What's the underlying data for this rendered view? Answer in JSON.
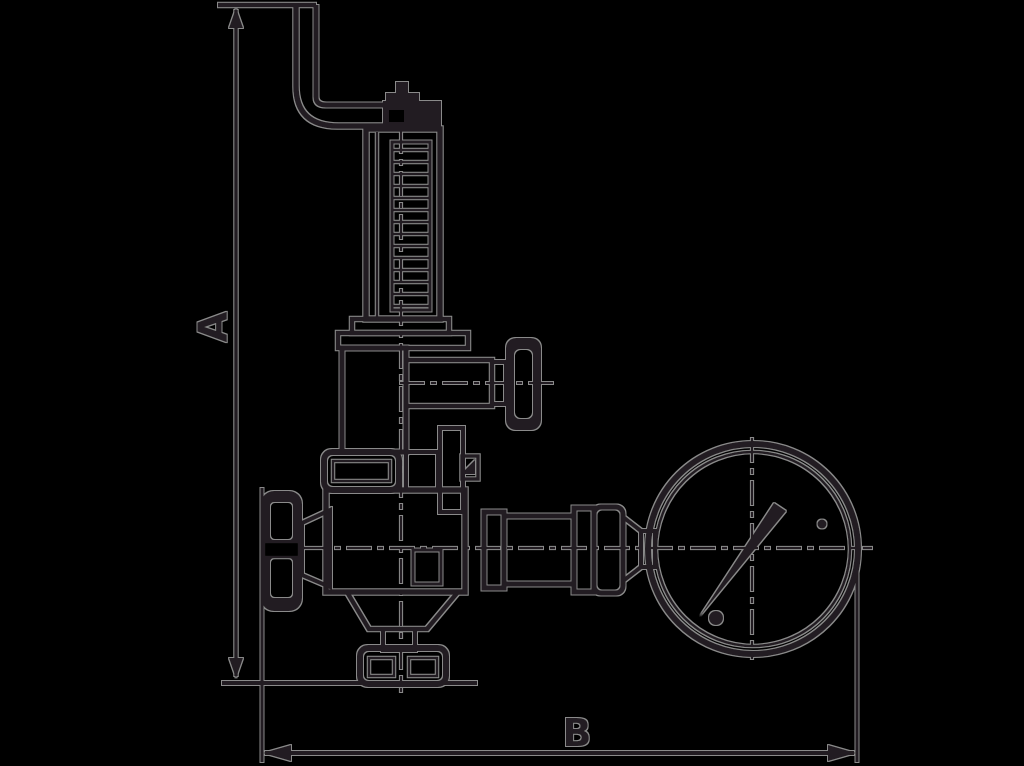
{
  "figure": {
    "title": "safety-valve-with-pressure-gauge-outline-drawing",
    "background_color": "#000000",
    "line_color": "#231f20",
    "halo_color": "#8a8a8a",
    "dimensions": {
      "vertical": {
        "label": "A"
      },
      "horizontal": {
        "label": "B"
      }
    }
  }
}
